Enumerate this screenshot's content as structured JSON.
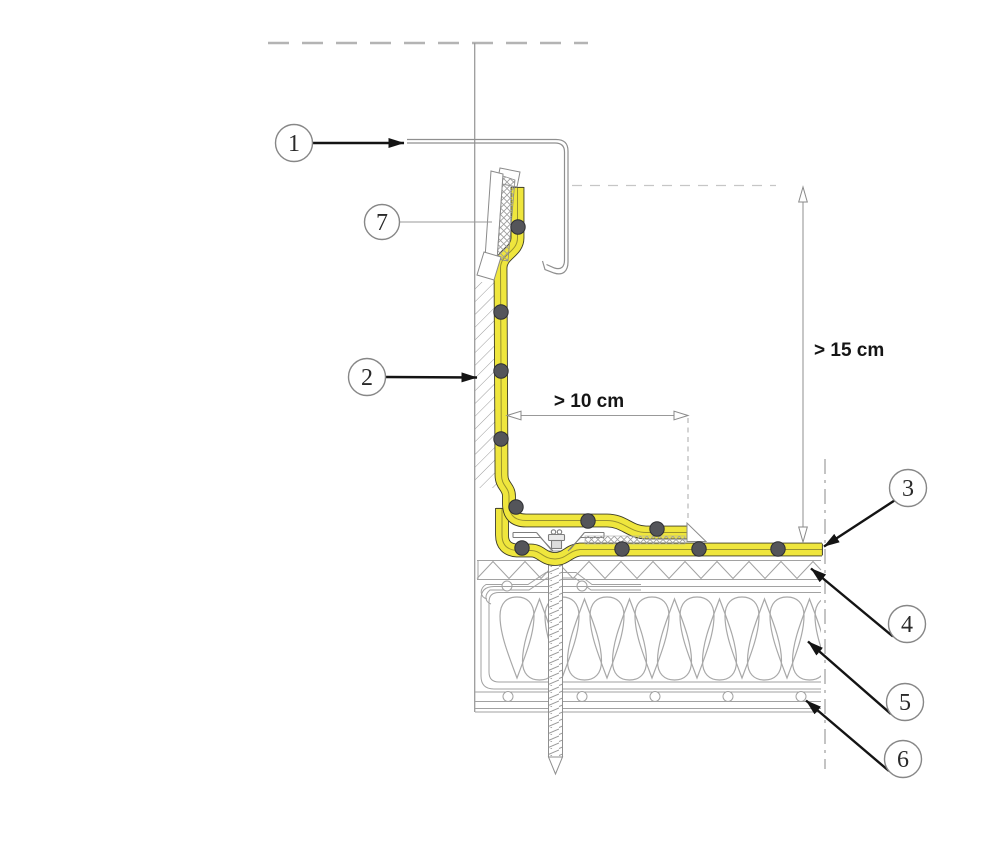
{
  "diagram": {
    "type": "construction-detail-section",
    "callouts": [
      {
        "label": "1"
      },
      {
        "label": "2"
      },
      {
        "label": "3"
      },
      {
        "label": "4"
      },
      {
        "label": "5"
      },
      {
        "label": "6"
      },
      {
        "label": "7"
      }
    ],
    "dimensions": {
      "vertical": "> 15 cm",
      "horizontal": "> 10 cm"
    },
    "colors": {
      "membrane": "#efe63d",
      "membrane_edge": "#3c3c28",
      "line_gray": "#9a9a9a",
      "arrow": "#141414",
      "dot": "#54555a"
    }
  }
}
